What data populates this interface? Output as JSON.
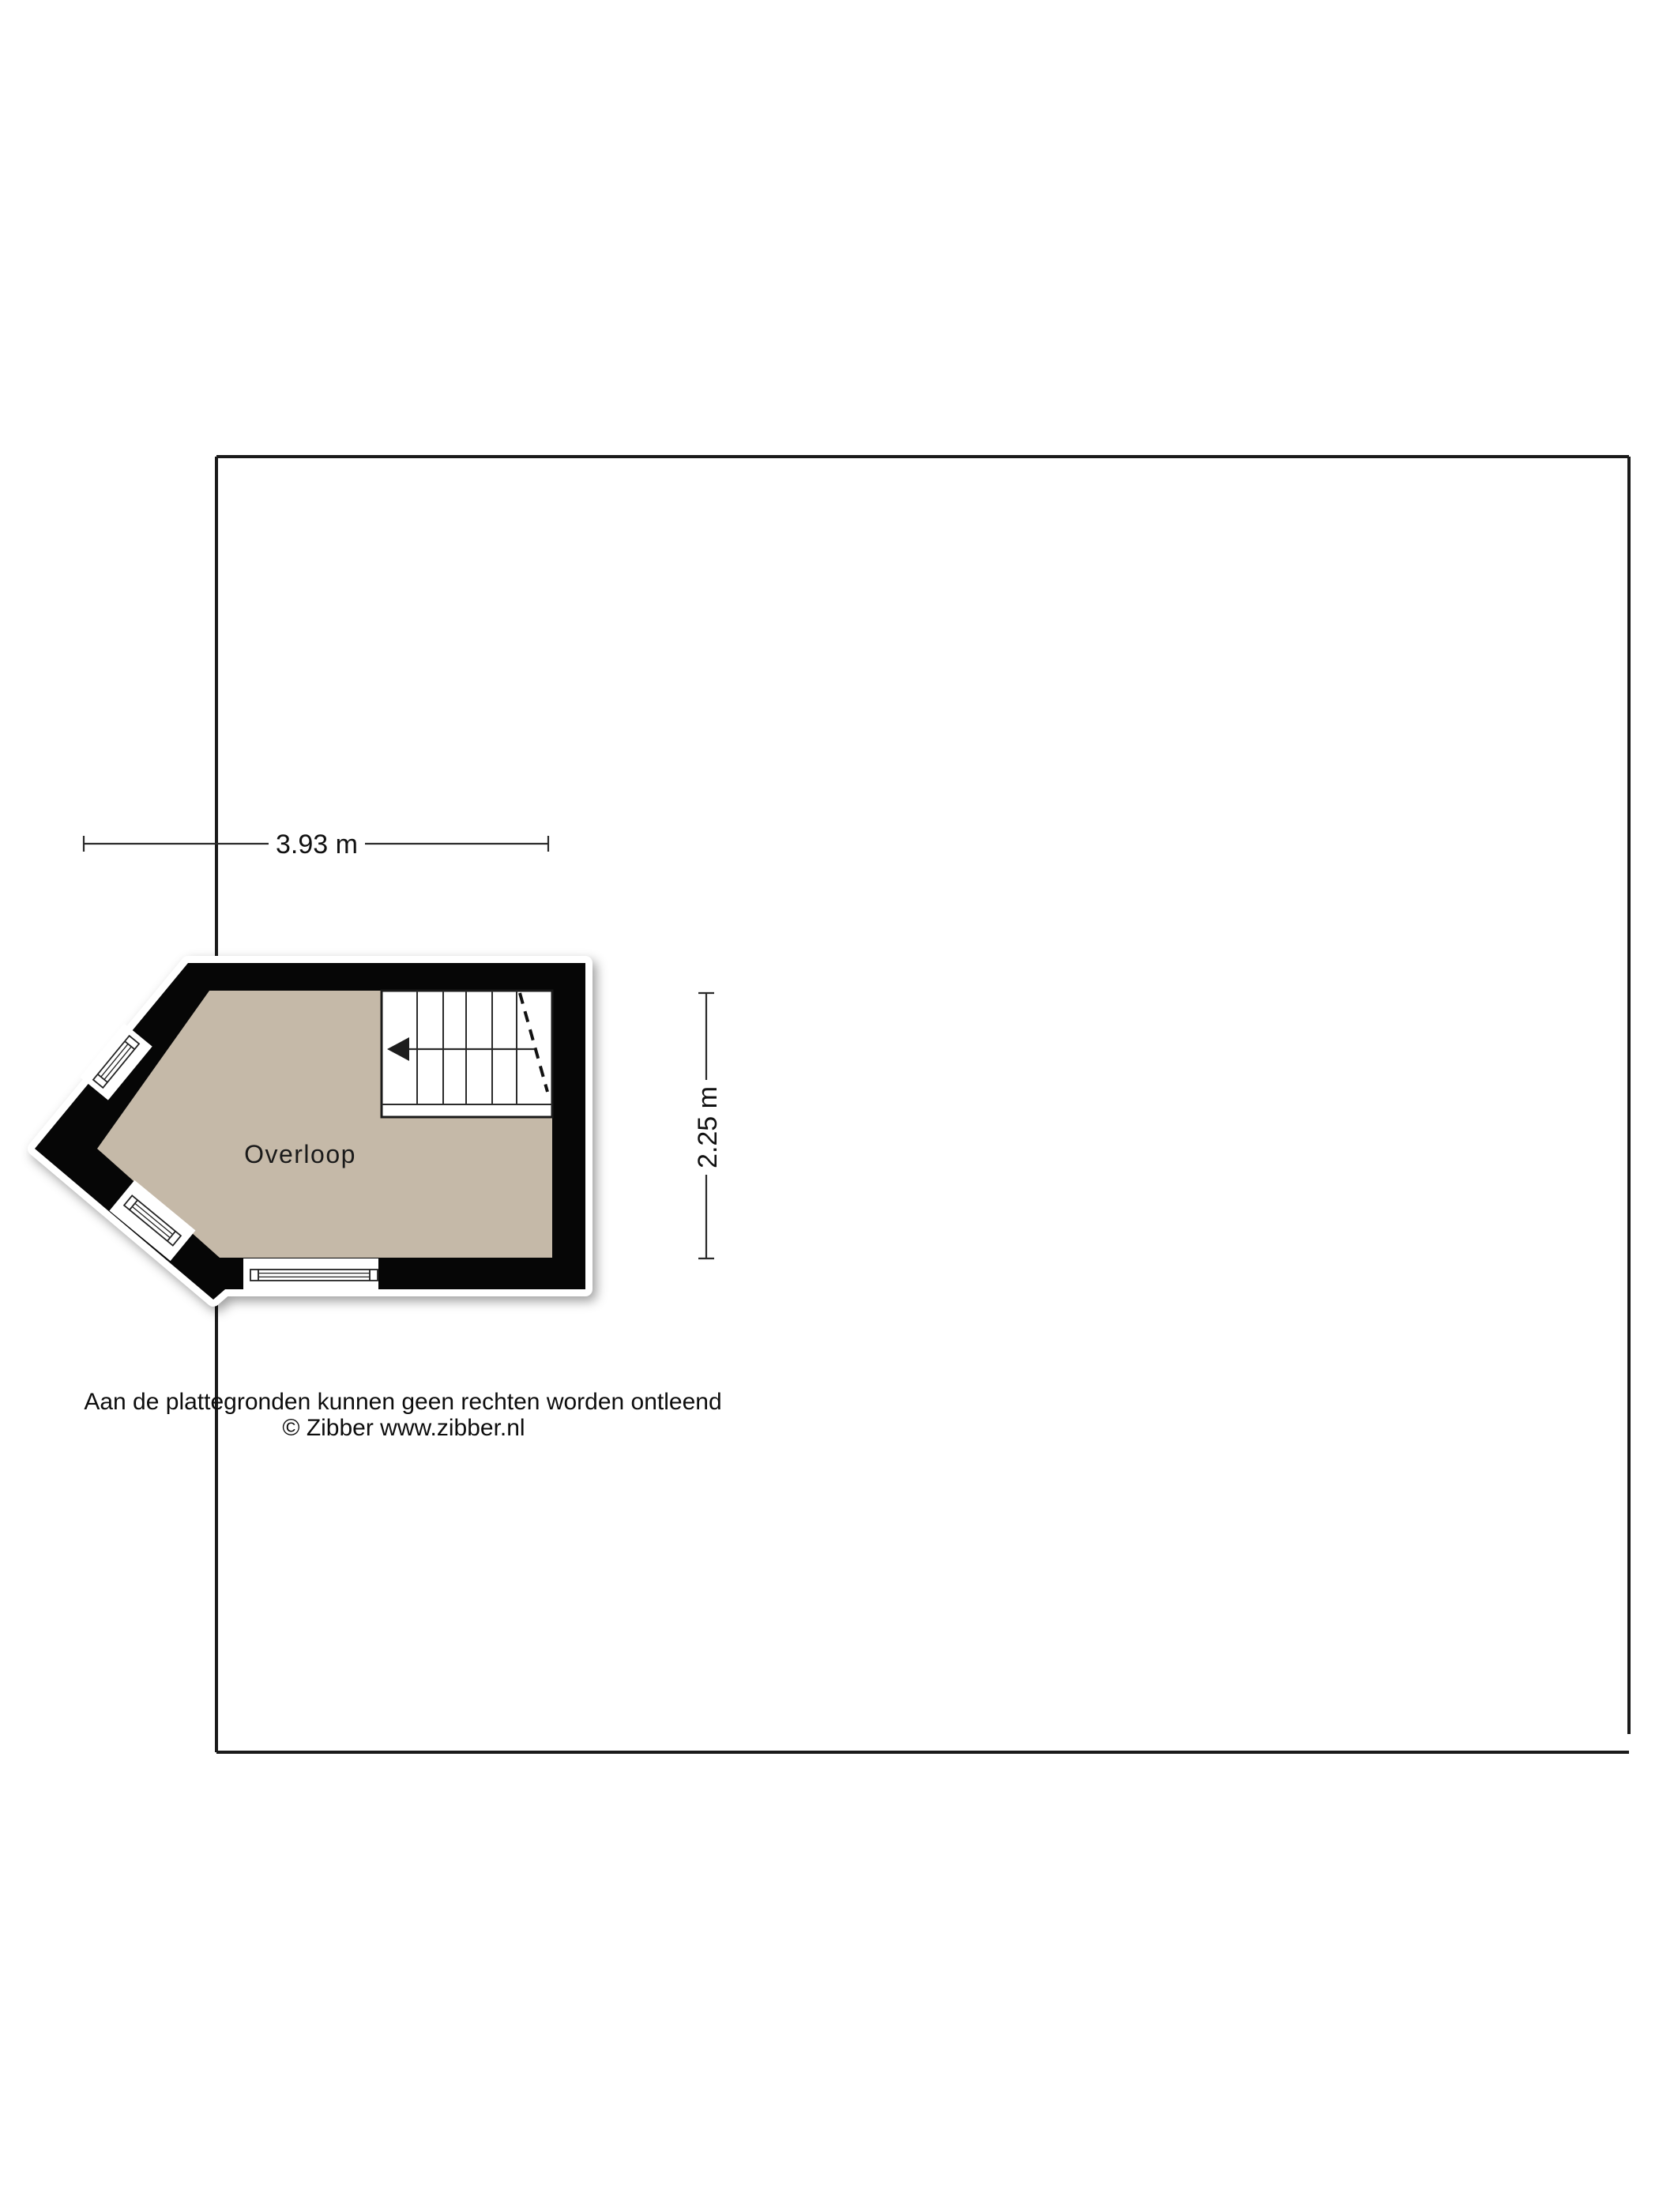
{
  "floorplan": {
    "room": {
      "label": "Overloop"
    },
    "dimensions": {
      "width_label": "3.93 m",
      "width_m": 3.93,
      "height_label": "2.25 m",
      "height_m": 2.25
    },
    "colors": {
      "floor": "#c5b9a8",
      "wall": "#060606",
      "page_background": "#ffffff"
    },
    "icons": {
      "stairs_arrow": "left-arrow",
      "stairs_cut": "dashed-cut-line"
    }
  },
  "footer": {
    "disclaimer": "Aan de plattegronden kunnen geen rechten worden ontleend",
    "copyright": "© Zibber www.zibber.nl"
  }
}
